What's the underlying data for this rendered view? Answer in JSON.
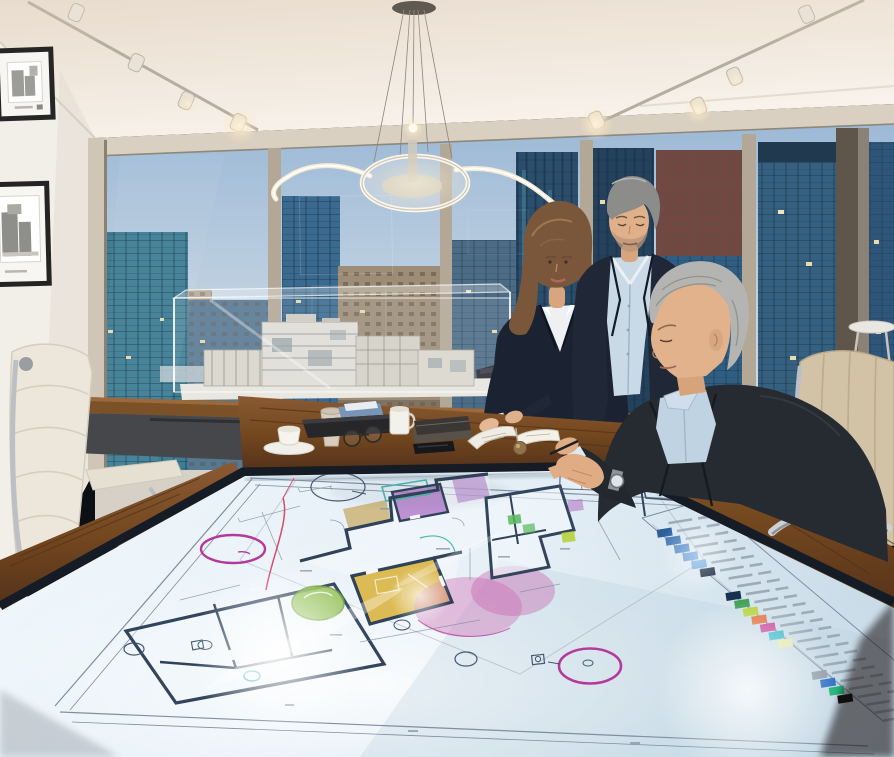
{
  "image": {
    "type": "photograph",
    "description": "Three business professionals review glowing architectural floor plans on an interactive touchscreen conference table in a high-rise corner office at dusk",
    "time_of_day": "dusk"
  },
  "palette": {
    "ceiling": "#efe5da",
    "ceiling_bright": "#f8f3ec",
    "wall": "#f2eee8",
    "header": "#d9d0c2",
    "floor": "#d6d0c6",
    "sky_top": "#9db9d6",
    "sky_bottom": "#d5dde2",
    "mullion": "#b3a896",
    "mullion_light": "#cfc6b6",
    "corner_wall": "#5e564b",
    "bldg_teal": "#3e7e95",
    "bldg_blue": "#3a6a90",
    "bldg_steel": "#4c6c86",
    "bldg_dark": "#2b4e6d",
    "bldg_navy": "#24425c",
    "bldg_beige": "#a5937a",
    "bldg_tan": "#9d8d76",
    "bldg_glass": "#2f5e82",
    "bldg_red": "#714842",
    "bldg_right": "#35607f",
    "lit_window": "#e8d9ae",
    "wood": "#7d4f2b",
    "wood_dark": "#5a361c",
    "bezel": "#151c26",
    "cabinet": "#45474a",
    "screen": "#e3eef6",
    "plan_line": "#32455c",
    "plan_thin": "#7b8b9c",
    "room_yellow": "#d9b33c",
    "room_green": "#8fbf4d",
    "room_purple": "#b079c8",
    "room_pink": "#cf6fb4",
    "room_olive": "#c9ae6b",
    "room_teal": "#49b8b0",
    "accent_magenta": "#b5399b",
    "accent_red": "#d84a6a",
    "suit_navy_w": "#1b2231",
    "suit_navy_m": "#202837",
    "suit_charcoal": "#262a31",
    "shirt_white": "#eef0f1",
    "shirt_blue": "#c9d9e6",
    "shirt_blue2": "#bfd3e2",
    "skin": "#e5b795",
    "skin_m": "#e0b08a",
    "skin_s": "#e2b28c",
    "hair_brown": "#7a573a",
    "hair_gray": "#8c8c8a",
    "hair_silver": "#b4b4b2",
    "chair_white": "#ece7da",
    "chair_beige": "#d2c3a7",
    "chrome": "#bcc0c5",
    "model": "#e2dfd6",
    "track": "#b5ad9f",
    "glow": "#fff3dc"
  },
  "scene": {
    "people": [
      {
        "id": "person-woman-standing",
        "description": "woman with shoulder-length brown hair, navy suit, white shirt, leaning on the table"
      },
      {
        "id": "person-man-standing",
        "description": "gray-haired man with stubble, navy suit, open light-blue shirt, looking down at the table"
      },
      {
        "id": "person-man-seated",
        "description": "silver-haired man in charcoal suit and blue shirt seated in a beige chair, reaching onto the touchscreen, silver wristwatch"
      }
    ],
    "furniture": [
      "interactive-blueprint-table",
      "white-leather-task-chair",
      "beige-leather-task-chair",
      "wood-credenza",
      "white-side-table"
    ],
    "lighting": [
      "track-lighting-left",
      "track-lighting-right",
      "ring-pendant-chandelier"
    ],
    "wall_decor": [
      "framed-architectural-drawing-1",
      "framed-architectural-drawing-2"
    ],
    "display_model": "white architectural scale model in clear acrylic case",
    "tabletop_items": [
      "teacup-and-saucer",
      "paper-coffee-cup",
      "dark-folio-with-blue-papers",
      "eyeglasses",
      "white-mug",
      "notebook-stack",
      "smartphone",
      "open-notebook",
      "brass-paperweight"
    ],
    "window_view": "city skyline of glass towers with lit windows at dusk"
  },
  "screen": {
    "content": "architectural site and floor plans",
    "features": [
      "thick-wall floor plans",
      "yellow highlighted room",
      "purple highlighted rooms",
      "green landscape circles",
      "pink overlay zones",
      "magenta annotation circles",
      "red markup line",
      "sheet border lines",
      "color-coded legend strip",
      "specular light flares"
    ]
  },
  "legend": {
    "rows": [
      {
        "swatch": null
      },
      {
        "swatch": "#2e5f9c"
      },
      {
        "swatch": "#3f74b5"
      },
      {
        "swatch": "#4f86c6"
      },
      {
        "swatch": "#5e97d3"
      },
      {
        "swatch": "#6ca7de"
      },
      {
        "swatch": "#14233b"
      },
      {
        "swatch": null
      },
      {
        "swatch": null
      },
      {
        "swatch": "#16324f"
      },
      {
        "swatch": "#3fa054"
      },
      {
        "swatch": "#b7d23e"
      },
      {
        "swatch": "#e2713f"
      },
      {
        "swatch": "#c8489c"
      },
      {
        "swatch": "#3ab8c8"
      },
      {
        "swatch": "#dfe9a8"
      },
      {
        "swatch": null
      },
      {
        "swatch": null
      },
      {
        "swatch": null
      },
      {
        "swatch": "#8e9aa4"
      },
      {
        "swatch": "#2a6fc4"
      },
      {
        "swatch": "#1fb275"
      },
      {
        "swatch": "#101010"
      },
      {
        "swatch": null
      },
      {
        "swatch": null
      },
      {
        "swatch": null
      }
    ]
  }
}
